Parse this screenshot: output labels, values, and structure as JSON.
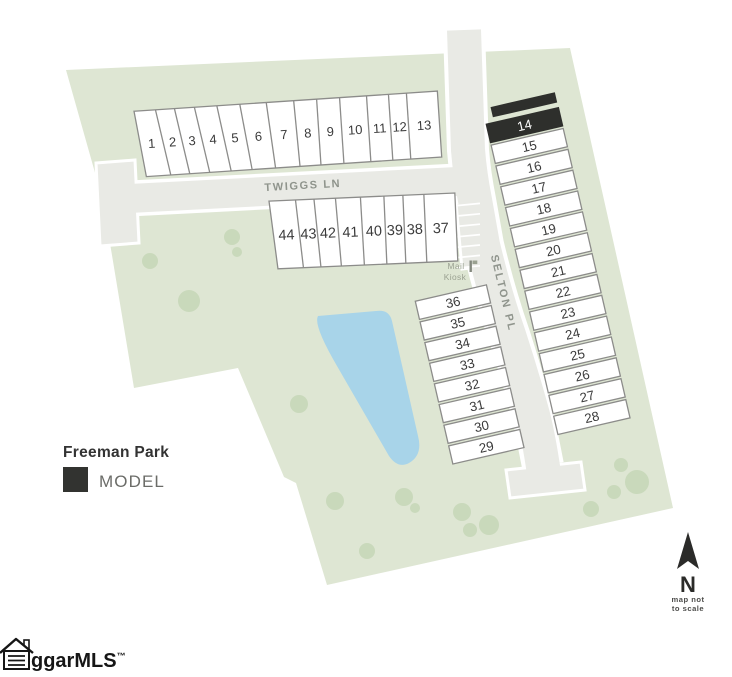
{
  "title": "Freeman Park",
  "legend": {
    "model_label": "MODEL"
  },
  "streets": {
    "twiggs_ln": "TWIGGS LN",
    "selton_pl": "SELTON PL"
  },
  "mail_kiosk": {
    "line1": "Mail",
    "line2": "Kiosk"
  },
  "compass": {
    "north_label": "N",
    "note_line1": "map not",
    "note_line2": "to scale"
  },
  "watermark": {
    "text": "ggarMLS",
    "tm": "™"
  },
  "model_lot": "14",
  "lots": {
    "twiggs_row": [
      "1",
      "2",
      "3",
      "4",
      "5",
      "6",
      "7",
      "8",
      "9",
      "10",
      "11",
      "12",
      "13"
    ],
    "inner_row": [
      "44",
      "43",
      "42",
      "41",
      "40",
      "39",
      "38",
      "37"
    ],
    "selton_west_col": [
      "36",
      "35",
      "34",
      "33",
      "32",
      "31",
      "30",
      "29"
    ],
    "selton_east_col": [
      "14",
      "15",
      "16",
      "17",
      "18",
      "19",
      "20",
      "21",
      "22",
      "23",
      "24",
      "25",
      "26",
      "27",
      "28"
    ]
  },
  "colors": {
    "land": "#dee6d3",
    "tree": "#c5d5b6",
    "pond": "#a8d4e9",
    "road": "#e9eae5",
    "road_casing": "#ffffff",
    "lot_fill": "#ffffff",
    "lot_stroke": "#8c8c8a",
    "model_fill": "#2e2f2c",
    "number_text": "#3a3a3a",
    "street_text": "#8f948c",
    "kiosk_text": "#9aa191",
    "dark_text": "#333333",
    "model_label_text": "#6b6c68",
    "compass": "#2b2b29",
    "watermark_text": "#161616"
  }
}
